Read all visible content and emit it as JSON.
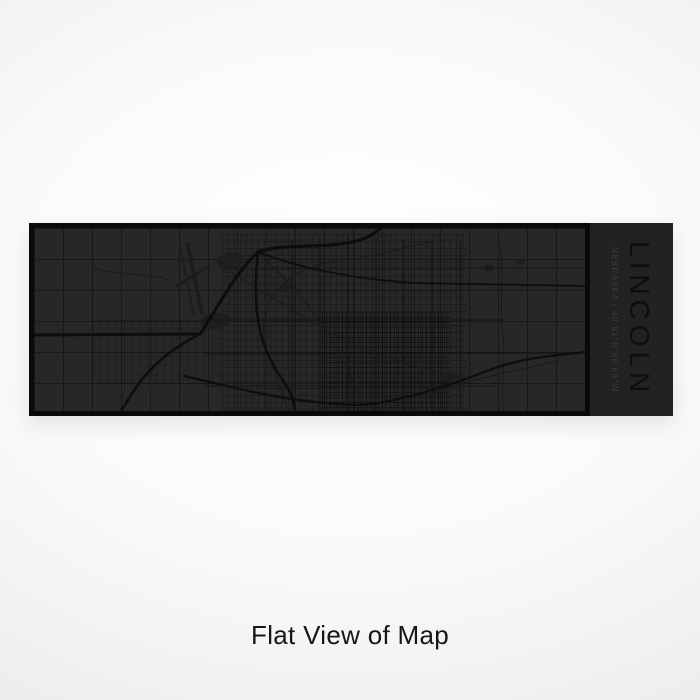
{
  "product": {
    "city": "LINCOLN",
    "subtitle": "NEBRASKA / 40.81°N 96.69°W"
  },
  "caption": "Flat View of Map",
  "map": {
    "description": "Dark engraved-style street map of Lincoln, Nebraska: rural section grid, dense downtown grid, I-80 and US-77 interchange, airport runways, Highway 2 diagonal, Salt Creek and lakes"
  },
  "colors": {
    "background_center": "#ffffff",
    "background_edge": "#d6d6d6",
    "map_background": "#272727",
    "map_frame": "#0a0a0a",
    "label_panel": "#222222",
    "road_major": "#0d0d0d",
    "road_minor": "#161616",
    "water": "#1e1e20",
    "title_text": "#0e0e0e",
    "subtitle_text": "#3e3e3e",
    "caption_text": "#161616"
  }
}
